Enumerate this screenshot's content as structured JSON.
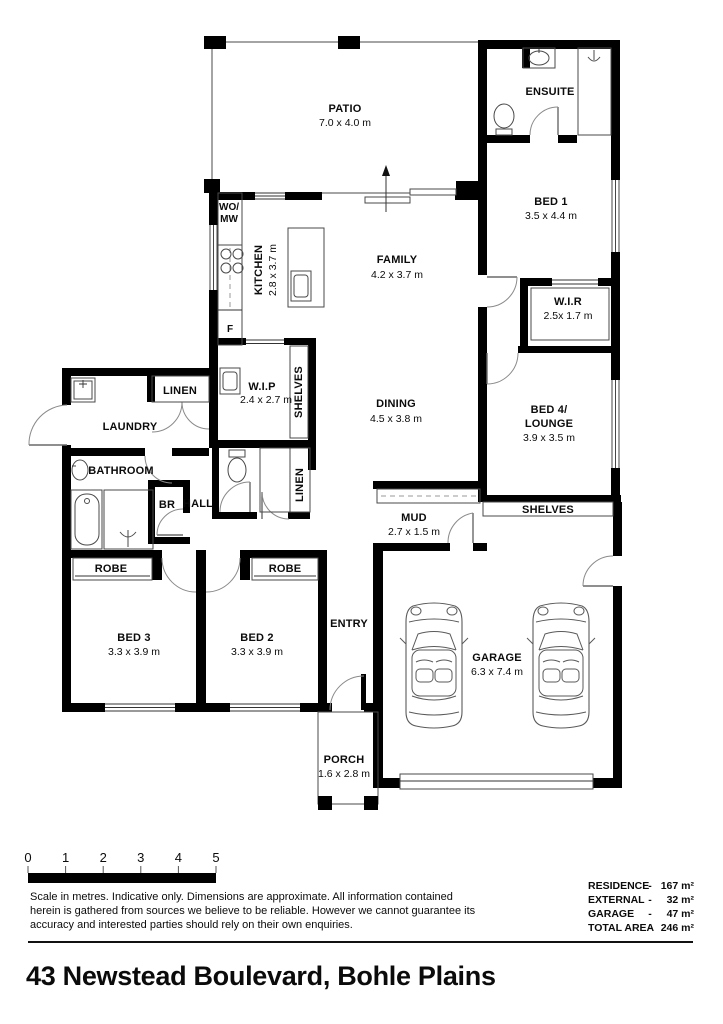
{
  "plan": {
    "patio": {
      "label": "PATIO",
      "dims": "7.0 x 4.0 m"
    },
    "ensuite": {
      "label": "ENSUITE"
    },
    "bed1": {
      "label": "BED 1",
      "dims": "3.5 x 4.4 m"
    },
    "kitchen": {
      "label": "KITCHEN",
      "dims": "2.8 x 3.7 m"
    },
    "family": {
      "label": "FAMILY",
      "dims": "4.2 x 3.7 m"
    },
    "wir": {
      "label": "W.I.R",
      "dims": "2.5x 1.7 m"
    },
    "wip": {
      "label": "W.I.P",
      "dims": "2.4 x 2.7 m"
    },
    "dining": {
      "label": "DINING",
      "dims": "4.5 x 3.8 m"
    },
    "bed4": {
      "label1": "BED 4/",
      "label2": "LOUNGE",
      "dims": "3.9 x 3.5 m"
    },
    "laundry": {
      "label": "LAUNDRY"
    },
    "linen_top": {
      "label": "LINEN"
    },
    "bathroom": {
      "label": "BATHROOM"
    },
    "br": {
      "label": "BR"
    },
    "hall": {
      "label": "HALL"
    },
    "linen_hall": {
      "label": "LINEN"
    },
    "shelves_wip": {
      "label": "SHELVES"
    },
    "shelves_garage": {
      "label": "SHELVES"
    },
    "mud": {
      "label": "MUD",
      "dims": "2.7 x 1.5 m"
    },
    "robe_left": {
      "label": "ROBE"
    },
    "robe_right": {
      "label": "ROBE"
    },
    "bed3": {
      "label": "BED 3",
      "dims": "3.3 x 3.9 m"
    },
    "bed2": {
      "label": "BED 2",
      "dims": "3.3 x 3.9 m"
    },
    "entry": {
      "label": "ENTRY"
    },
    "garage": {
      "label": "GARAGE",
      "dims": "6.3 x 7.4 m"
    },
    "porch": {
      "label": "PORCH",
      "dims": "1.6 x 2.8 m"
    },
    "appliances": {
      "wall_oven_line1": "WO/",
      "wall_oven_line2": "MW",
      "fridge": "F"
    }
  },
  "footer": {
    "scale_ticks": [
      "0",
      "1",
      "2",
      "3",
      "4",
      "5"
    ],
    "disclaimer": [
      "Scale in metres. Indicative only. Dimensions are approximate. All information contained",
      "herein is gathered from sources we believe to be reliable. However we cannot guarantee its",
      "accuracy and interested parties should rely on their own enquiries."
    ],
    "areas": [
      {
        "label": "RESIDENCE",
        "sep": "-",
        "value": "167 m²"
      },
      {
        "label": "EXTERNAL",
        "sep": "-",
        "value": "32 m²"
      },
      {
        "label": "GARAGE",
        "sep": "-",
        "value": "47 m²"
      },
      {
        "label": "TOTAL AREA",
        "sep": "-",
        "value": "246 m²"
      }
    ],
    "address": "43 Newstead Boulevard, Bohle Plains"
  }
}
